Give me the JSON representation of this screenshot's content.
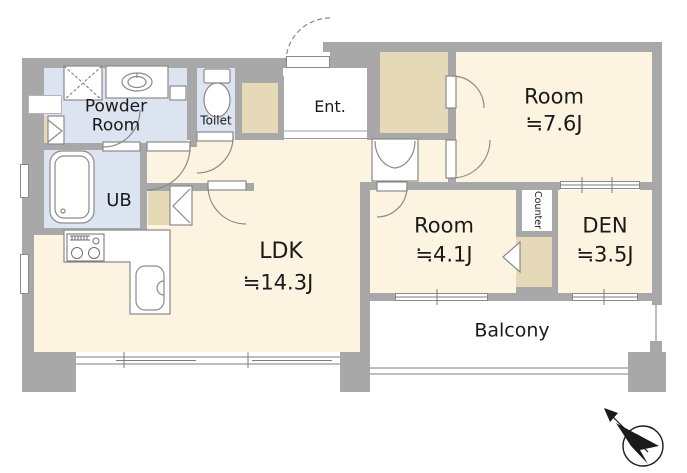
{
  "floorplan": {
    "rooms": [
      {
        "name": "Powder Room"
      },
      {
        "name": "Toilet"
      },
      {
        "name": "UB"
      },
      {
        "name": "Ent."
      },
      {
        "name": "Room",
        "area": "≒7.6J"
      },
      {
        "name": "Room",
        "area": "≒4.1J"
      },
      {
        "name": "DEN",
        "area": "≒3.5J"
      },
      {
        "name": "Counter"
      },
      {
        "name": "LDK",
        "area": "≒14.3J"
      },
      {
        "name": "Balcony"
      }
    ],
    "fixtures": [
      "washing-machine-space",
      "wash-basin",
      "toilet-bowl",
      "bathtub",
      "kitchen-stove",
      "kitchen-sink"
    ],
    "compass": {
      "icon": "north-arrow",
      "direction": "upper-left"
    },
    "colors": {
      "wall": "#a8a8a8",
      "room_floor": "#fcf3e0",
      "closet": "#e6d9b8",
      "wet_area": "#dce3f1",
      "balcony_floor": "#ffffff",
      "line": "#8a8a8a",
      "text": "#1a1a1a"
    }
  }
}
